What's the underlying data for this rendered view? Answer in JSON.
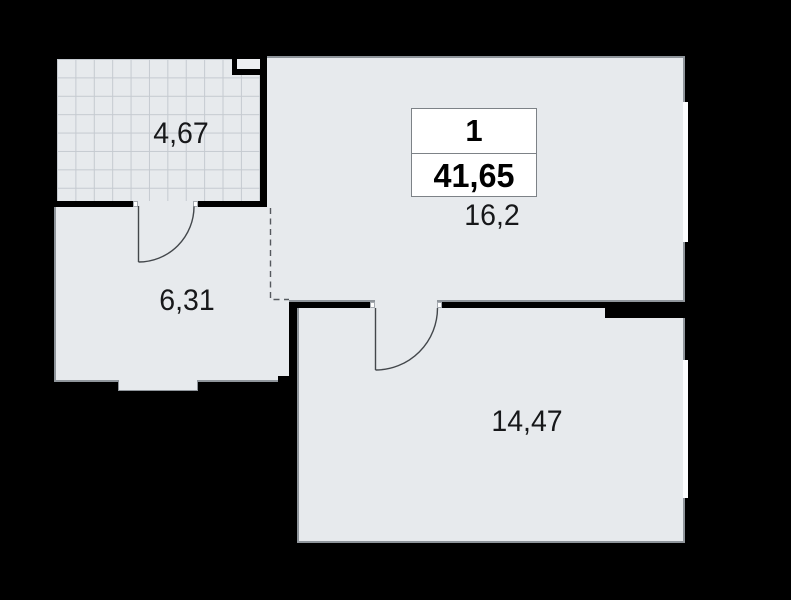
{
  "plan": {
    "summary_box": {
      "rooms_count": "1",
      "total_area": "41,65"
    },
    "rooms": [
      {
        "id": "loggia",
        "area_label": "4,67"
      },
      {
        "id": "hallway",
        "area_label": "6,31"
      },
      {
        "id": "living-room",
        "area_label": "16,2"
      },
      {
        "id": "bedroom",
        "area_label": "14,47"
      }
    ],
    "features": {
      "doors": [
        "loggia-to-hallway swing door",
        "living-to-bedroom swing door"
      ],
      "windows": [
        "living-room right wall",
        "bedroom right wall"
      ],
      "open_boundary": "dashed line between hallway and living room"
    },
    "colors": {
      "background": "#000000",
      "floor": "#e7eaed",
      "wall": "#000000",
      "grid_line": "#c5cad0",
      "window": "#fcfdff",
      "edge_line": "#8f959b",
      "door_line": "#43474b",
      "label_text": "#17181a"
    }
  }
}
